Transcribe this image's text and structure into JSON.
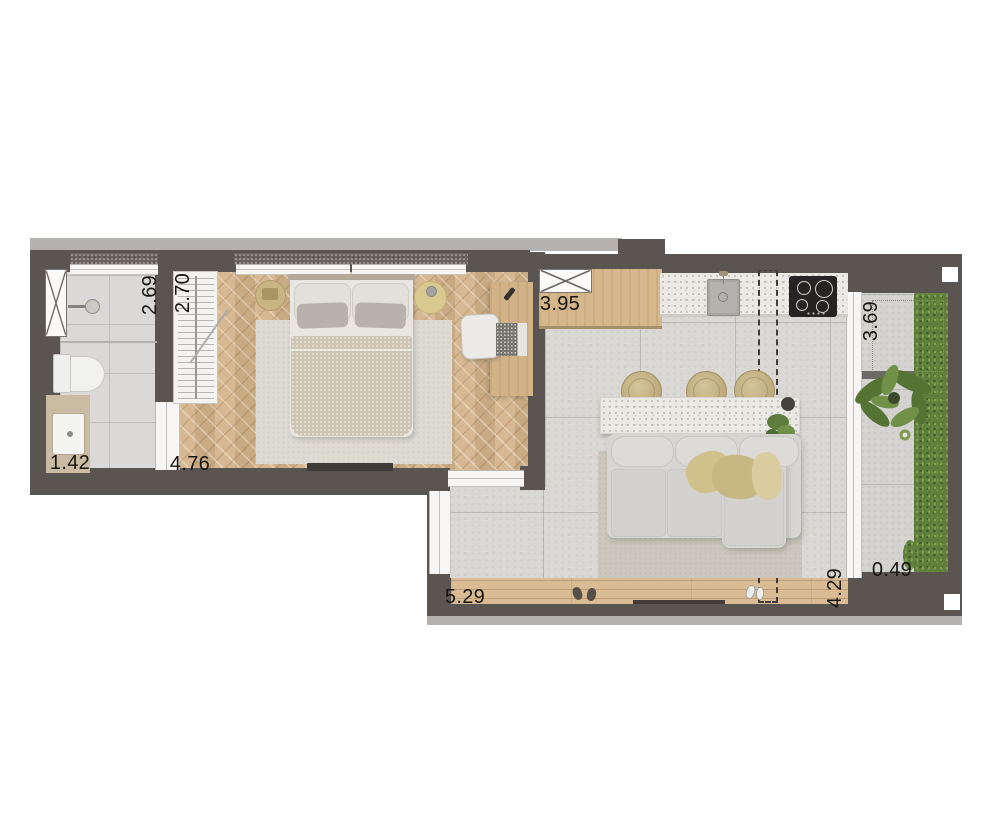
{
  "plan": {
    "title": "studio-apartment-floor-plan",
    "dimensions": {
      "bathroom_depth": "2.69",
      "closet_length": "2.70",
      "vanity_width": "1.42",
      "bedroom_width": "4.76",
      "kitchen_width": "3.95",
      "balcony_length": "3.69",
      "balcony_width": "0.49",
      "living_depth": "4.29",
      "living_width": "5.29"
    },
    "colors": {
      "wall": "#5b5552",
      "wall_edge": "#b5b1ae",
      "wood_floor": "#d3b48a",
      "tile_floor": "#dad8d4",
      "deck": "#d9bc93",
      "hedge_green": "#5f7d3b",
      "plant_green": "#557434",
      "counter": "#ebe9e4",
      "stool_tan": "#c2b183",
      "sofa_gray": "#d7d5d1",
      "blanket_khaki": "#c9ba84",
      "label_text": "#17140f"
    }
  }
}
